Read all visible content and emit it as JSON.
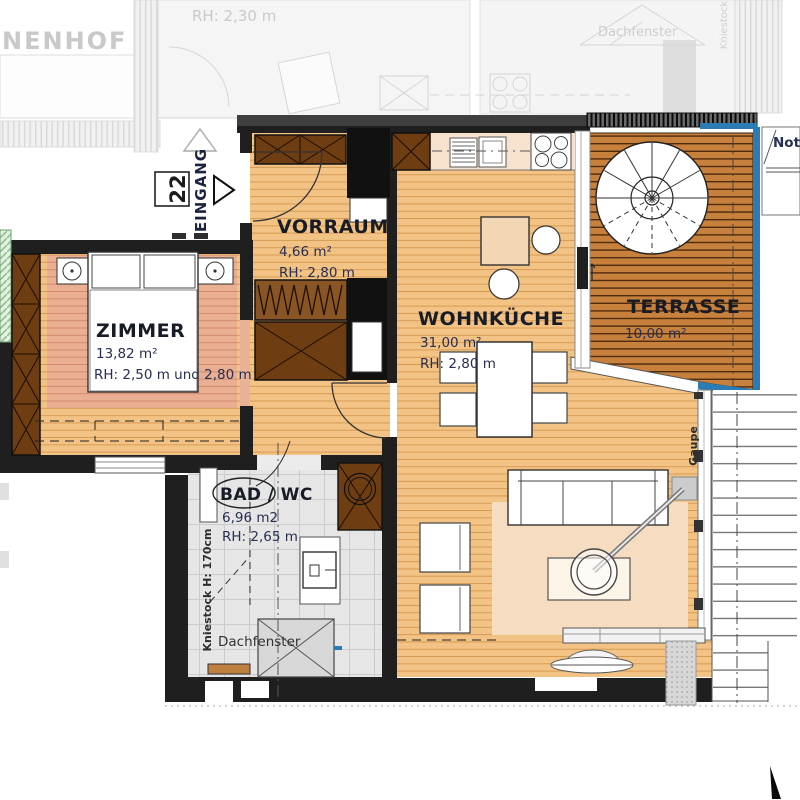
{
  "rooms": {
    "vorraum": {
      "name": "VORRAUM",
      "area": "4,66 m²",
      "height": "RH: 2,80 m"
    },
    "zimmer": {
      "name": "ZIMMER",
      "area": "13,82 m²",
      "height": "RH: 2,50 m und 2,80 m"
    },
    "wohnkueche": {
      "name": "WOHNKÜCHE",
      "area": "31,00 m²",
      "height": "RH: 2,80 m"
    },
    "terrasse": {
      "name": "TERRASSE",
      "area": "10,00 m²"
    },
    "bad": {
      "name": "BAD / WC",
      "area": "6,96 m2",
      "height": "RH: 2,65 m"
    }
  },
  "entrance": {
    "unit": "22",
    "label": "EINGANG"
  },
  "annotations": {
    "kniestock_bad": "Kniestock H: 170cm",
    "dachfenster_bad": "Dachfenster",
    "gaupe": "Gaupe",
    "not_label": "Not"
  },
  "neighbor": {
    "innenhof": "NENHOF",
    "rh": "RH: 2,30 m",
    "dachfenster": "Dachfenster",
    "kniestock": "Kniestock"
  },
  "colors": {
    "wood": "#f2c385",
    "deck": "#c8803d",
    "rug_bedroom": "#eaae92",
    "rug_living": "#f6dcc1",
    "cabinet_brown": "#6f3d12",
    "wall": "#1f1f1f",
    "water_blue": "#2b7cb5",
    "tile": "#e6e6e6",
    "faded": "#c9c9c9"
  }
}
